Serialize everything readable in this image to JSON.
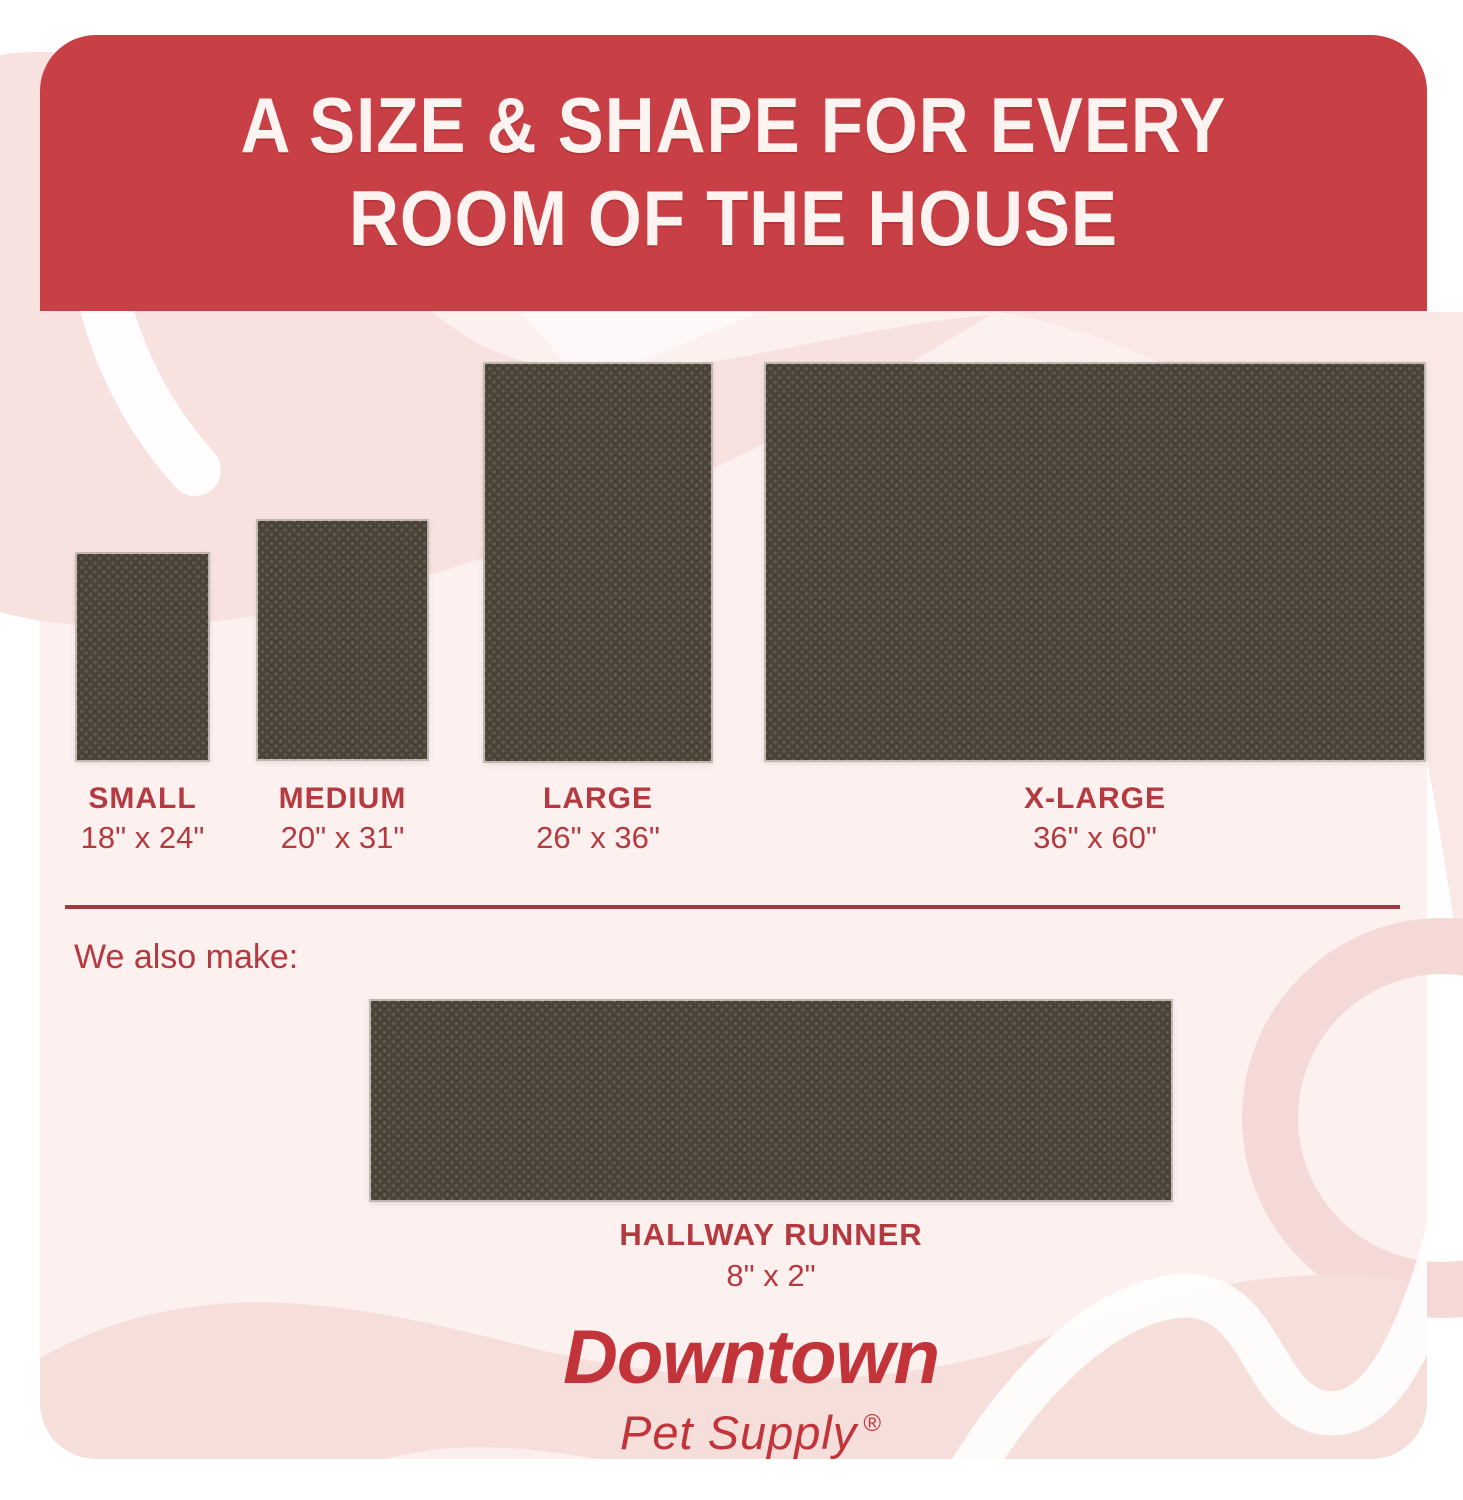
{
  "header": {
    "title_line1": "A SIZE & SHAPE FOR EVERY",
    "title_line2": "ROOM OF THE HOUSE"
  },
  "sizes": [
    {
      "label": "SMALL",
      "dimensions": "18\" x 24\""
    },
    {
      "label": "MEDIUM",
      "dimensions": "20\" x 31\""
    },
    {
      "label": "LARGE",
      "dimensions": "26\" x 36\""
    },
    {
      "label": "X-LARGE",
      "dimensions": "36\" x 60\""
    }
  ],
  "also_make": {
    "intro": "We also make:",
    "item": {
      "label": "HALLWAY RUNNER",
      "dimensions": "8\" x 2\""
    }
  },
  "brand": {
    "name": "Downtown",
    "tagline": "Pet Supply",
    "registered_mark": "®"
  },
  "colors": {
    "header_red": "#c84045",
    "text_red": "#b53a40",
    "logo_red": "#c2343a",
    "mat_brown": "#4a4137",
    "card_pink": "#fdf1ef",
    "decor_pink": "#f7e2df"
  }
}
